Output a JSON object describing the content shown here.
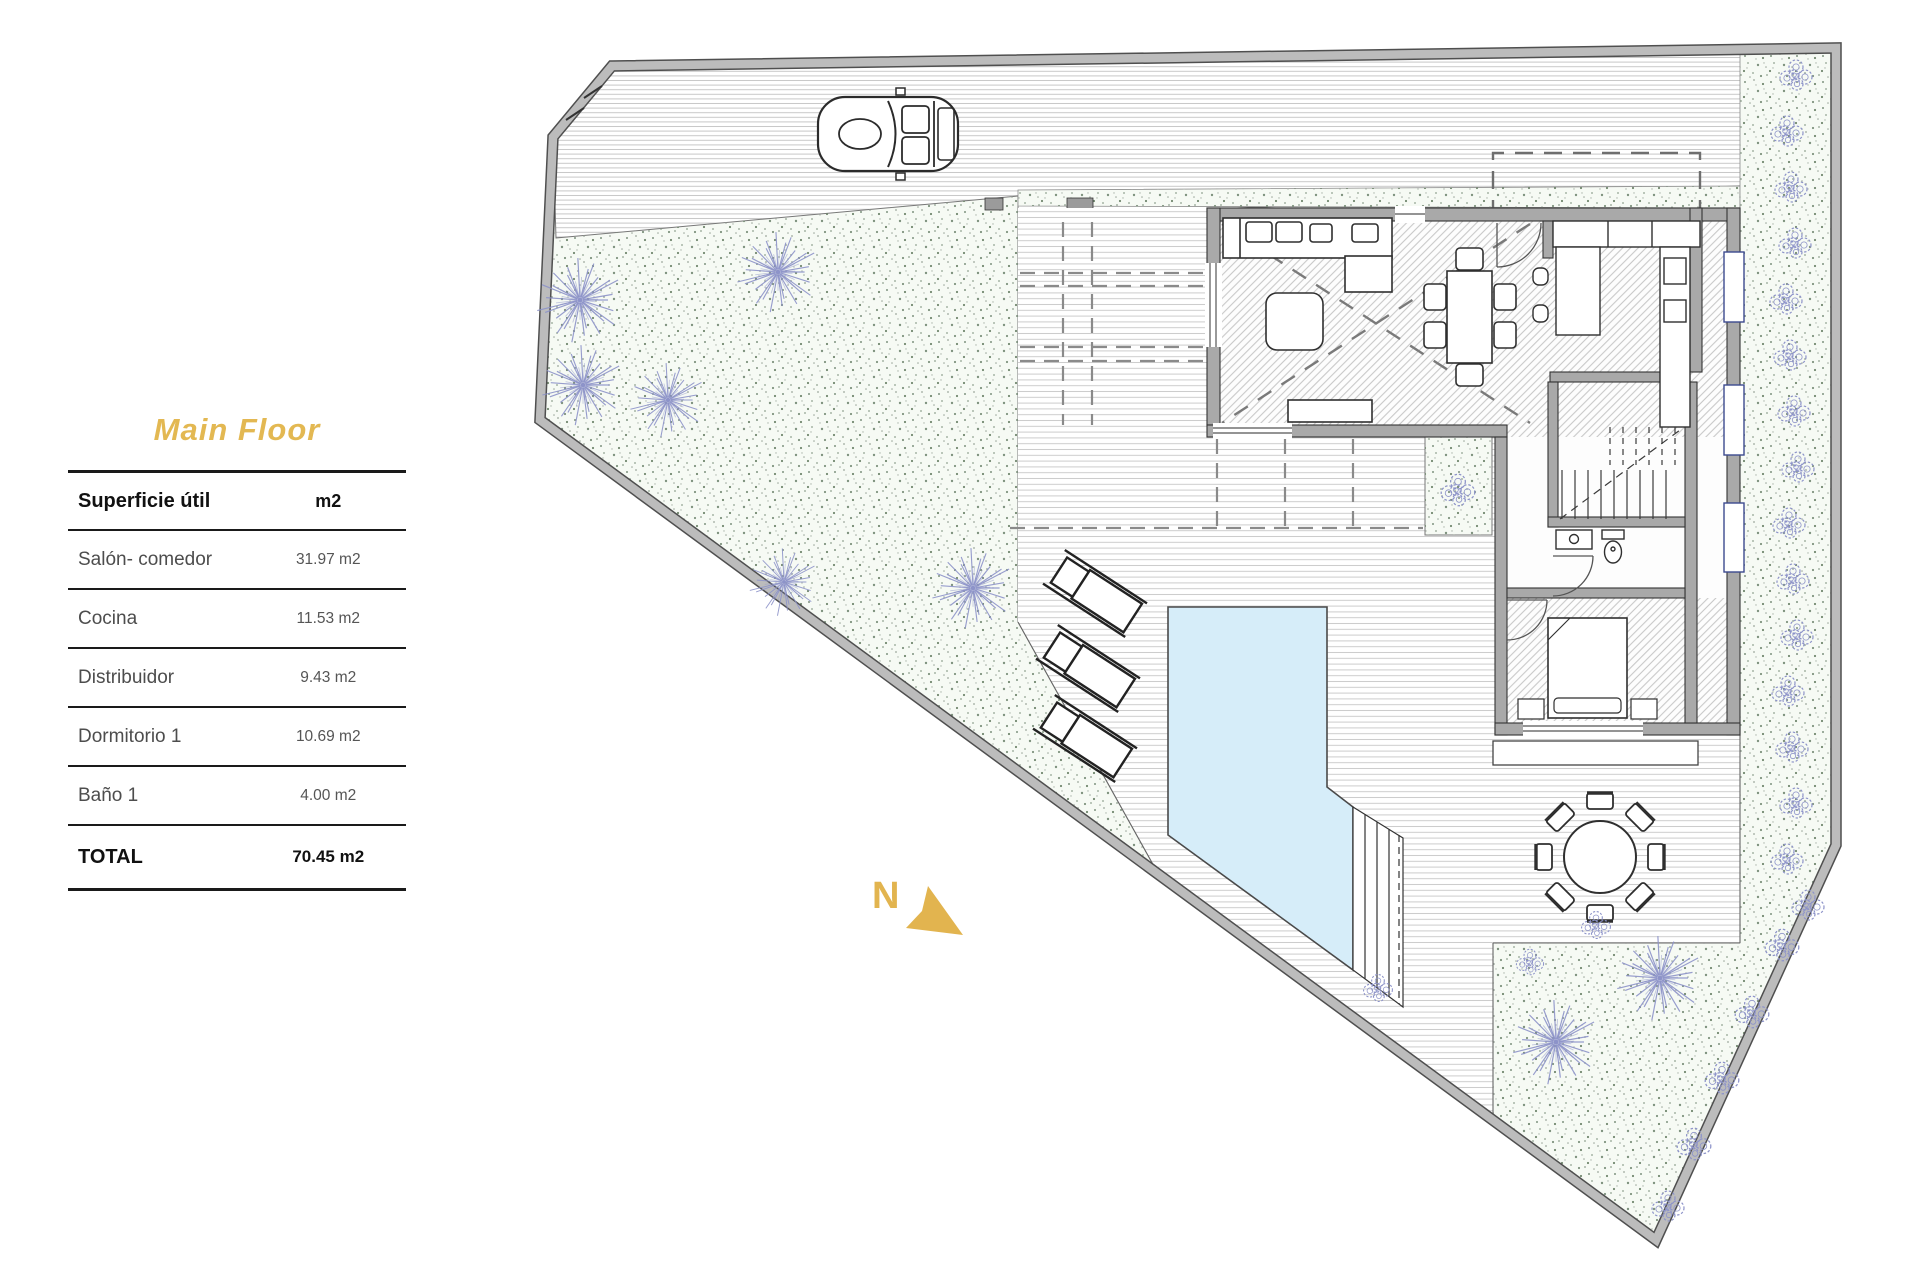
{
  "panel": {
    "title": "Main Floor",
    "table": {
      "col1": "Superficie útil",
      "col2": "m2",
      "rows": [
        {
          "label": "Salón- comedor",
          "value": "31.97 m2"
        },
        {
          "label": "Cocina",
          "value": "11.53 m2"
        },
        {
          "label": "Distribuidor",
          "value": "9.43 m2"
        },
        {
          "label": "Dormitorio 1",
          "value": "10.69 m2"
        },
        {
          "label": "Baño 1",
          "value": "4.00 m2"
        }
      ],
      "total_label": "TOTAL",
      "total_value": "70.45 m2"
    }
  },
  "plan": {
    "north_label": "N",
    "colors": {
      "accent_gold": "#e2b44f",
      "pool_water": "#d6edf9",
      "tree_stroke": "#8d93c9",
      "wall_gray": "#a9a9a9",
      "boundary_gray": "#bcbcbc"
    }
  }
}
